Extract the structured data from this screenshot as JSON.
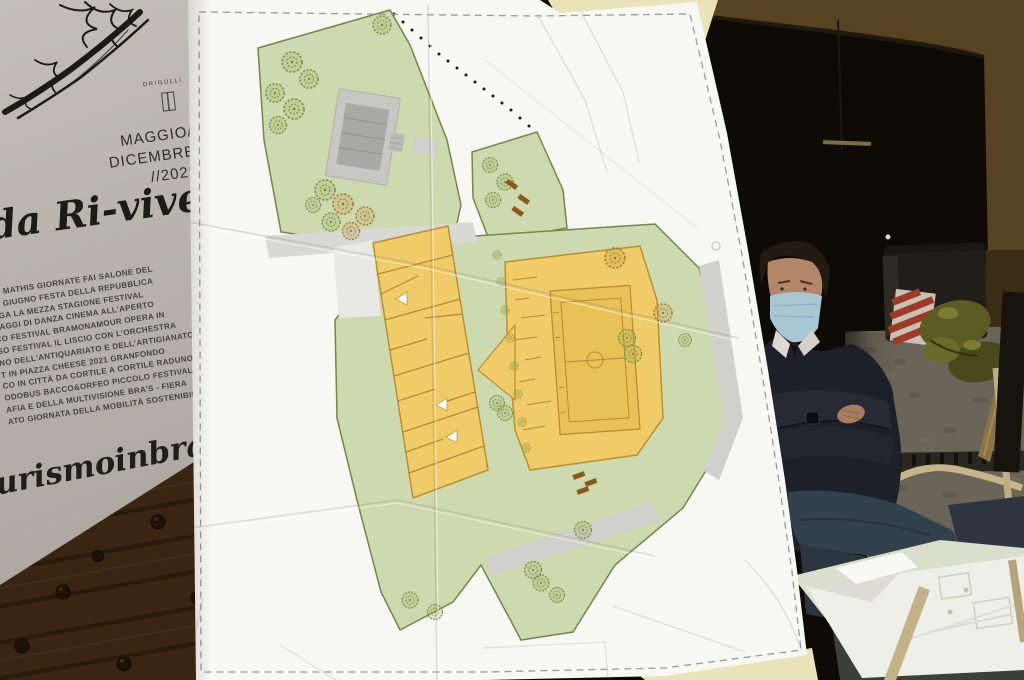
{
  "poster": {
    "artist_signature": "DRIGULLI",
    "period_lines": [
      "MAGGIO/",
      "DICEMBRE",
      "//2021"
    ],
    "title_script": "da Ri-viver",
    "events": [
      "ZO MATHIS GIORNATE FAI SALONE DEL",
      "I 2 GIUGNO FESTA DELLA REPUBBLICA",
      "OGA LA MEZZA STAGIONE FESTIVAL",
      "SAGGI DI DANZA CINEMA ALL'APERTO",
      "CO FESTIVAL BRAMONAMOUR OPERA IN",
      "SO FESTIVAL IL LISCIO CON L'ORCHESTRA",
      "NO DELL'ANTIQUARIATO E DELL'ARTIGIANATO",
      "T IN PIAZZA CHEESE 2021 GRANFONDO",
      "CO IN CITTÀ DA CORTILE A CORTILE RADUNO",
      "ODOBUS BACCO&ORFEO PICCOLO FESTIVAL",
      "AFIA E DELLA MULTIVISIONE BRA'S - FIERA",
      "ATO GIORNATA DELLA MOBILITÀ SOSTENIBILE"
    ],
    "website_script": "turismoinbra.it",
    "colors": {
      "paper": "#b6b2ab",
      "ink": "#2b2925"
    }
  },
  "site_plan": {
    "colors": {
      "sheet_paper": "#f7f7f4",
      "lawn_green": "#cdd9ae",
      "lawn_border": "#75864c",
      "building_yellow": "#f0cb67",
      "building_outline": "#b98f33",
      "interior_walls": "#ad7c2c",
      "path_gray": "#d2d2ce",
      "structure_gray": "#a9aaa7",
      "bench_brown": "#8a5a1d"
    }
  },
  "scene": {
    "colors": {
      "door_wood": "#3a2513",
      "arch_wall": "#574222",
      "dark_room": "#0e0b07",
      "face_mask_blue": "#a9c6d4",
      "sweater_navy": "#1e2029",
      "jeans_blue": "#33414d",
      "cobblestone": "#6b6459",
      "hazard_red": "#9e3a28",
      "chair_wood": "#c7b68c",
      "backing_board_yellow": "#eae3b9"
    }
  }
}
